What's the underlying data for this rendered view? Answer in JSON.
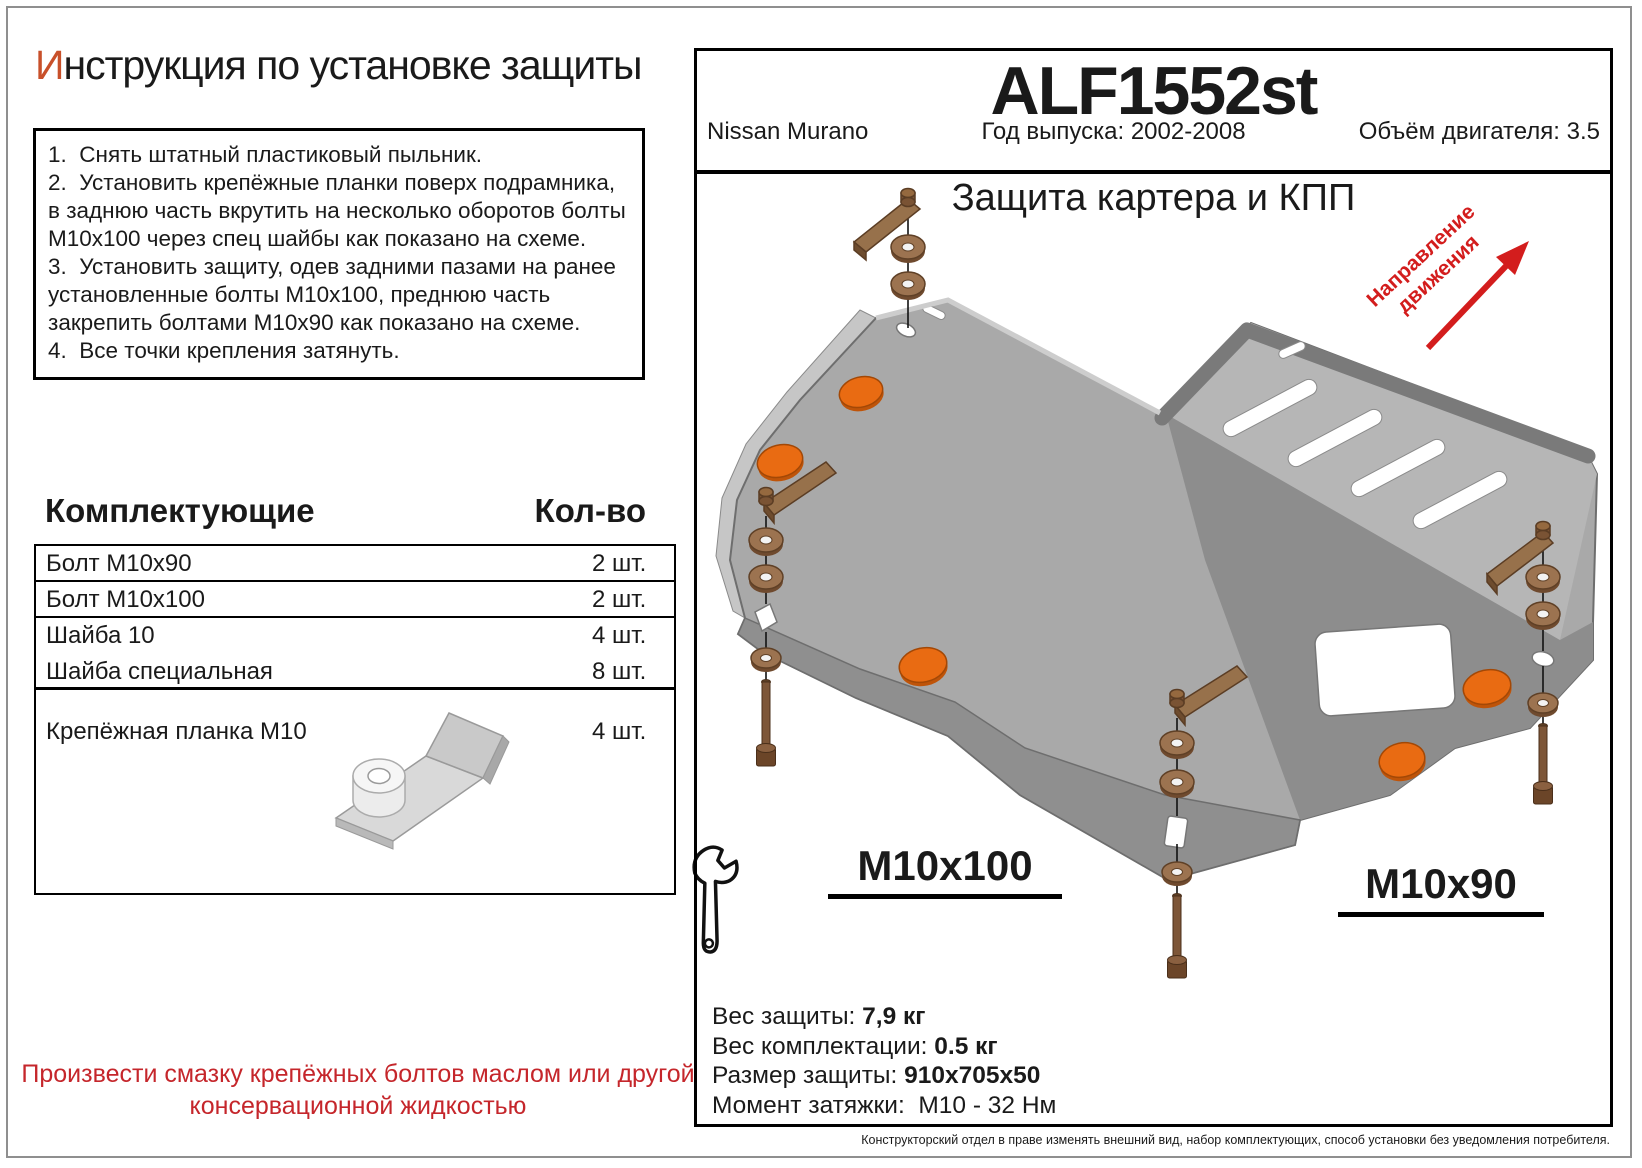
{
  "left": {
    "title_first": "И",
    "title_rest": "нструкция по установке защиты",
    "instructions": [
      "1.  Снять штатный пластиковый пыльник.",
      "2.  Установить крепёжные планки поверх подрамника, в заднюю часть вкрутить на несколько оборотов болты М10х100 через спец шайбы как показано на схеме.",
      "3.  Установить защиту, одев задними пазами на ранее установленные болты М10х100, преднюю часть закрепить болтами М10х90 как показано на схеме.",
      "4.  Все точки крепления затянуть."
    ],
    "parts": {
      "header": {
        "name": "Комплектующие",
        "qty": "Кол-во"
      },
      "rows": [
        {
          "name": "Болт М10х90",
          "qty": "2 шт."
        },
        {
          "name": "Болт М10х100",
          "qty": "2 шт."
        },
        {
          "name": "Шайба 10",
          "qty": "4 шт."
        },
        {
          "name": "Шайба специальная",
          "qty": "8 шт."
        },
        {
          "name": "Крепёжная планка М10",
          "qty": "4 шт."
        }
      ]
    },
    "warning": "Произвести смазку крепёжных болтов маслом или другой консервационной жидкостью"
  },
  "panel": {
    "code": "ALF1552st",
    "car": "Nissan Murano",
    "year": "Год выпуска: 2002-2008",
    "engine": "Объём двигателя: 3.5",
    "subtitle": "Защита картера и КПП",
    "direction_line1": "Направление",
    "direction_line2": "движения",
    "label_front": "M10x100",
    "label_rear": "M10x90",
    "specs": [
      {
        "label": "Вес защиты: ",
        "value": "7,9 кг"
      },
      {
        "label": "Вес комплектации: ",
        "value": "0.5 кг"
      },
      {
        "label": "Размер защиты: ",
        "value": "910х705х50"
      },
      {
        "label": "Момент затяжки:  ",
        "value": "М10 - 32 Нм"
      }
    ],
    "footnote": "Конструкторский отдел в праве изменять внешний вид, набор комплектующих, способ установки без уведомления потребителя."
  },
  "colors": {
    "accent_letter": "#c8502a",
    "warning_red": "#c5262b",
    "arrow_red": "#d31d1d",
    "plate_gray": "#a9a9a9",
    "plate_dark": "#8d8d8d",
    "plate_light": "#b6b6b6",
    "hardware_brown": "#9c7350",
    "plug_orange": "#e96b12"
  }
}
